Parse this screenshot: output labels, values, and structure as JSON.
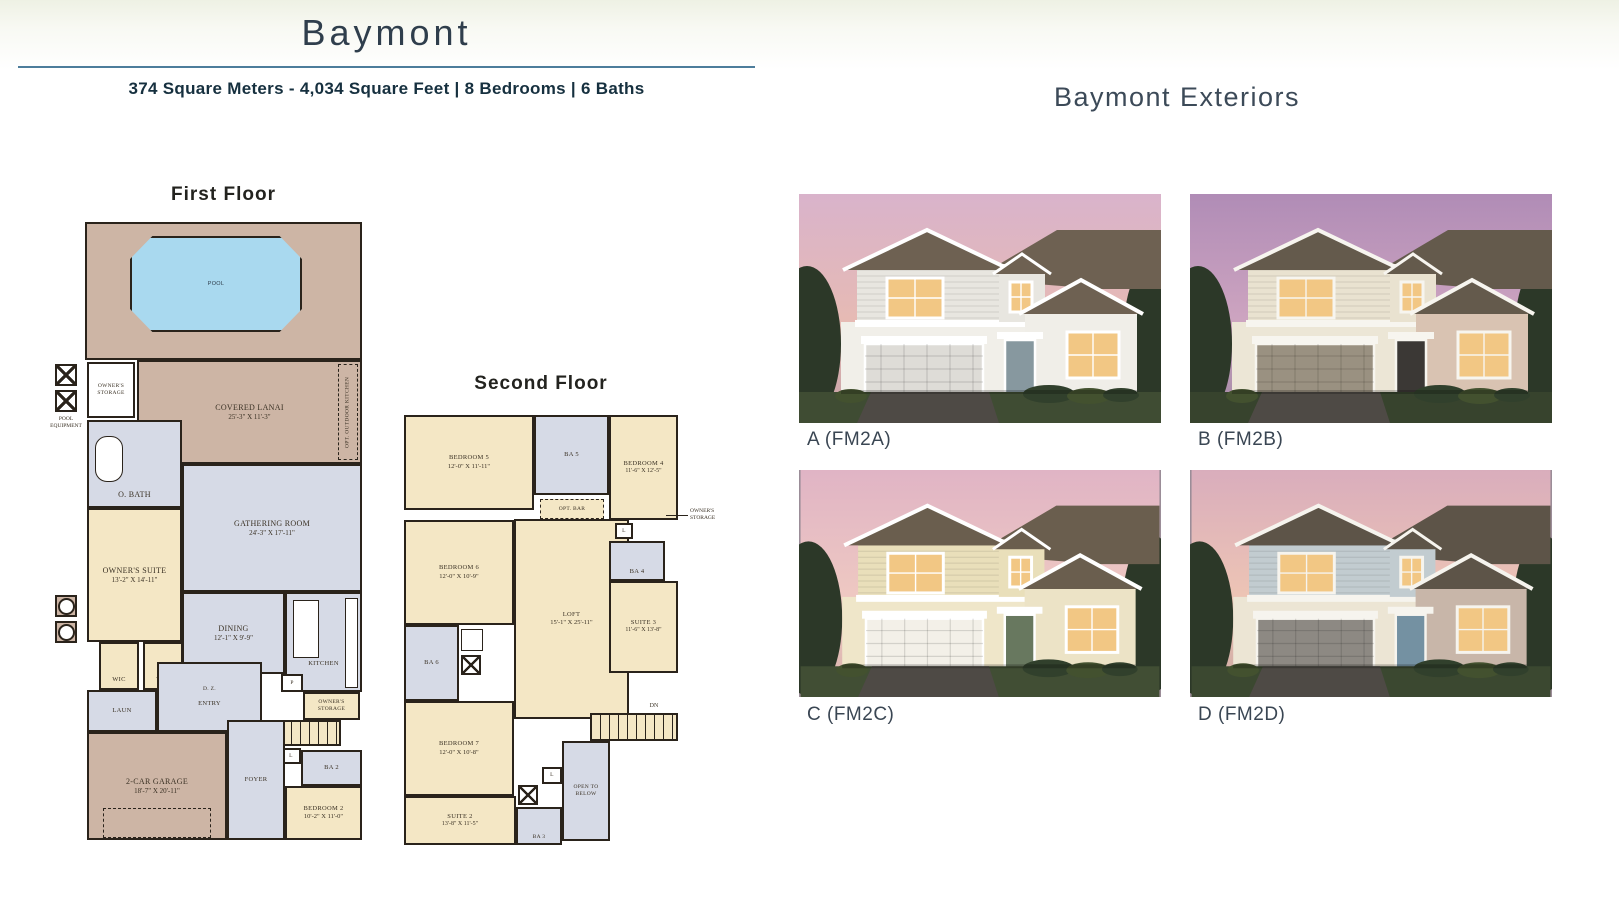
{
  "page": {
    "title": "Baymont",
    "subtitle": "374 Square Meters - 4,034 Square Feet  |  8 Bedrooms  |  6 Baths"
  },
  "palette": {
    "heading": "#2f3e4c",
    "divider_line": "#4d7d9b",
    "plan_deck_tan": "#cdb5a5",
    "plan_room_cream": "#f4e7c5",
    "plan_room_lavender": "#d6dae6",
    "plan_pool_blue": "#a9d9ef",
    "plan_wall": "#2a231b"
  },
  "first_floor": {
    "heading": "First Floor",
    "rooms": {
      "pool": "POOL",
      "covered_lanai": "COVERED LANAI",
      "covered_lanai_dims": "25'-3\" X 11'-3\"",
      "opt_outdoor_kitchen": "OPT. OUTDOOR KITCHEN",
      "owners_storage": "OWNER'S STORAGE",
      "pool_equipment": "POOL EQUIPMENT",
      "o_bath": "O. BATH",
      "gathering_room": "GATHERING ROOM",
      "gathering_room_dims": "24'-3\" X 17'-11\"",
      "owners_suite": "OWNER'S SUITE",
      "owners_suite_dims": "13'-2\" X 14'-11\"",
      "dining": "DINING",
      "dining_dims": "12'-1\" X 9'-9\"",
      "kitchen": "KITCHEN",
      "wic_left": "WIC",
      "wic_right": "WIC",
      "laun": "LAUN",
      "dz": "D. Z.",
      "entry": "ENTRY",
      "pantry": "P",
      "owners_storage_2": "OWNER'S STORAGE",
      "up": "UP",
      "linen": "L",
      "ba2": "BA 2",
      "garage": "2-CAR GARAGE",
      "garage_dims": "18'-7\" X 20'-11\"",
      "foyer": "FOYER",
      "bedroom2": "BEDROOM 2",
      "bedroom2_dims": "10'-2\" X 11'-0\""
    }
  },
  "second_floor": {
    "heading": "Second Floor",
    "rooms": {
      "bedroom5": "BEDROOM 5",
      "bedroom5_dims": "12'-0\" X 11'-11\"",
      "ba5": "BA 5",
      "bedroom4": "BEDROOM 4",
      "bedroom4_dims": "11'-6\" X 12'-5\"",
      "opt_bar": "OPT. BAR",
      "owners_storage": "OWNER'S STORAGE",
      "ba4": "BA 4",
      "bedroom6": "BEDROOM 6",
      "bedroom6_dims": "12'-0\" X 10'-9\"",
      "loft": "LOFT",
      "loft_dims": "15'-1\" X 25'-11\"",
      "suite3": "SUITE 3",
      "suite3_dims": "11'-6\" X 13'-8\"",
      "ba6": "BA 6",
      "bedroom7": "BEDROOM 7",
      "bedroom7_dims": "12'-0\" X 10'-8\"",
      "dn": "DN",
      "open_to_below": "OPEN TO BELOW",
      "suite2": "SUITE 2",
      "suite2_dims": "13'-8\" X 11'-5\"",
      "ba3": "BA 3",
      "linen1": "L",
      "linen2": "L"
    }
  },
  "exteriors": {
    "heading": "Baymont Exteriors",
    "items": [
      {
        "label": "A (FM2A)",
        "colors": {
          "sky_top": "#d9b3cb",
          "sky_mid": "#e6bab4",
          "sky_horizon": "#c4a0a6",
          "siding": "#e8e6e0",
          "stucco": "#f1efe9",
          "wing": "#f0eee8",
          "roof": "#6e6152",
          "garage": "#dedcd7",
          "door": "#87989f",
          "trim": "#ffffff",
          "lawn": "#3f4c33"
        }
      },
      {
        "label": "B (FM2B)",
        "colors": {
          "sky_top": "#b08cb6",
          "sky_mid": "#cda4c0",
          "sky_horizon": "#a087a4",
          "siding": "#e9e2d0",
          "stucco": "#ece6d6",
          "wing": "#d9c3b2",
          "roof": "#645a4c",
          "garage": "#9a9181",
          "door": "#3b3835",
          "trim": "#f7f5ef",
          "lawn": "#37432d"
        }
      },
      {
        "label": "C (FM2C)",
        "colors": {
          "sky_top": "#e0b4c5",
          "sky_mid": "#eec8c2",
          "sky_horizon": "#d8b2ac",
          "siding": "#e9dfba",
          "stucco": "#efe6c9",
          "wing": "#ece3c6",
          "roof": "#6a5e4e",
          "garage": "#f3f0e8",
          "door": "#68785f",
          "trim": "#ffffff",
          "lawn": "#414e34"
        }
      },
      {
        "label": "D (FM2D)",
        "colors": {
          "sky_top": "#d9adbc",
          "sky_mid": "#edc4b5",
          "sky_horizon": "#cba7a2",
          "siding": "#c2ccd0",
          "stucco": "#ece5d4",
          "wing": "#c8b6a9",
          "roof": "#5d5448",
          "garage": "#8d8983",
          "door": "#7491a2",
          "trim": "#f6f4ee",
          "lawn": "#3b4830"
        }
      }
    ]
  }
}
